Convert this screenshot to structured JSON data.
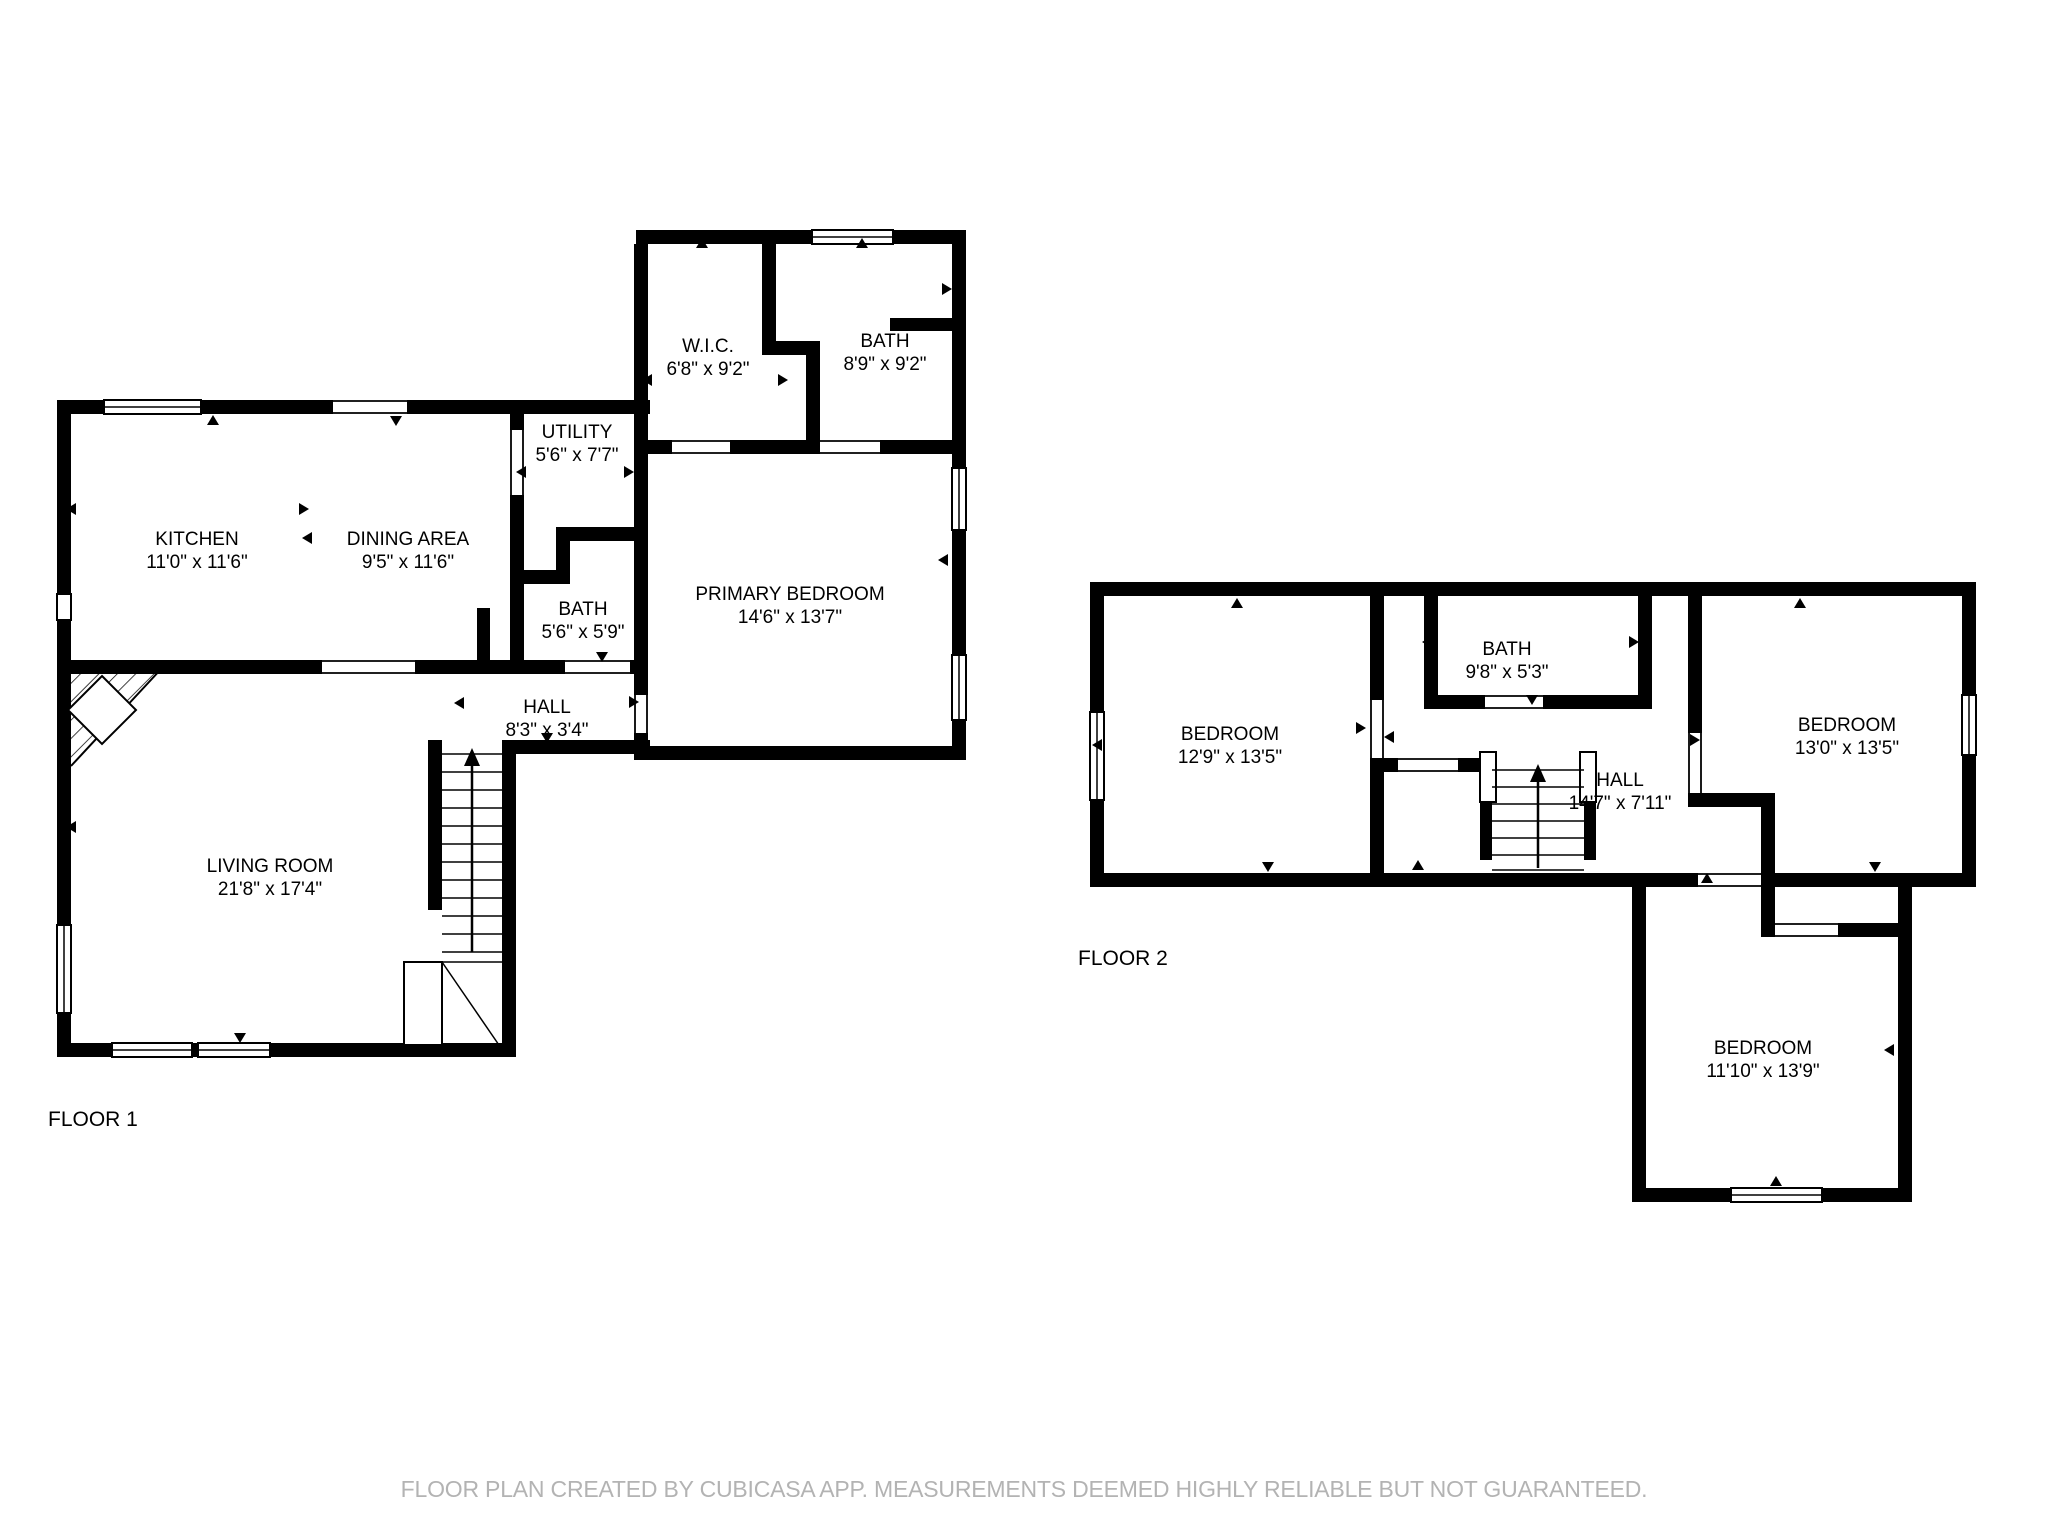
{
  "colors": {
    "background": "#ffffff",
    "walls": "#000000",
    "room_text": "#000000",
    "footer_text": "#b3b3b3"
  },
  "floor1": {
    "label": "FLOOR 1",
    "rooms": [
      {
        "name": "KITCHEN",
        "dims": "11'0\" x 11'6\""
      },
      {
        "name": "DINING AREA",
        "dims": "9'5\" x 11'6\""
      },
      {
        "name": "UTILITY",
        "dims": "5'6\" x 7'7\""
      },
      {
        "name": "BATH",
        "dims": "5'6\" x 5'9\""
      },
      {
        "name": "HALL",
        "dims": "8'3\" x 3'4\""
      },
      {
        "name": "LIVING ROOM",
        "dims": "21'8\" x 17'4\""
      },
      {
        "name": "W.I.C.",
        "dims": "6'8\" x 9'2\""
      },
      {
        "name": "BATH",
        "dims": "8'9\" x 9'2\""
      },
      {
        "name": "PRIMARY BEDROOM",
        "dims": "14'6\" x 13'7\""
      }
    ]
  },
  "floor2": {
    "label": "FLOOR 2",
    "rooms": [
      {
        "name": "BEDROOM",
        "dims": "12'9\" x 13'5\""
      },
      {
        "name": "BATH",
        "dims": "9'8\" x 5'3\""
      },
      {
        "name": "HALL",
        "dims": "14'7\" x 7'11\""
      },
      {
        "name": "BEDROOM",
        "dims": "13'0\" x 13'5\""
      },
      {
        "name": "BEDROOM",
        "dims": "11'10\" x 13'9\""
      }
    ]
  },
  "footer": {
    "text": "FLOOR PLAN CREATED BY CUBICASA APP. MEASUREMENTS DEEMED HIGHLY RELIABLE BUT NOT GUARANTEED."
  }
}
